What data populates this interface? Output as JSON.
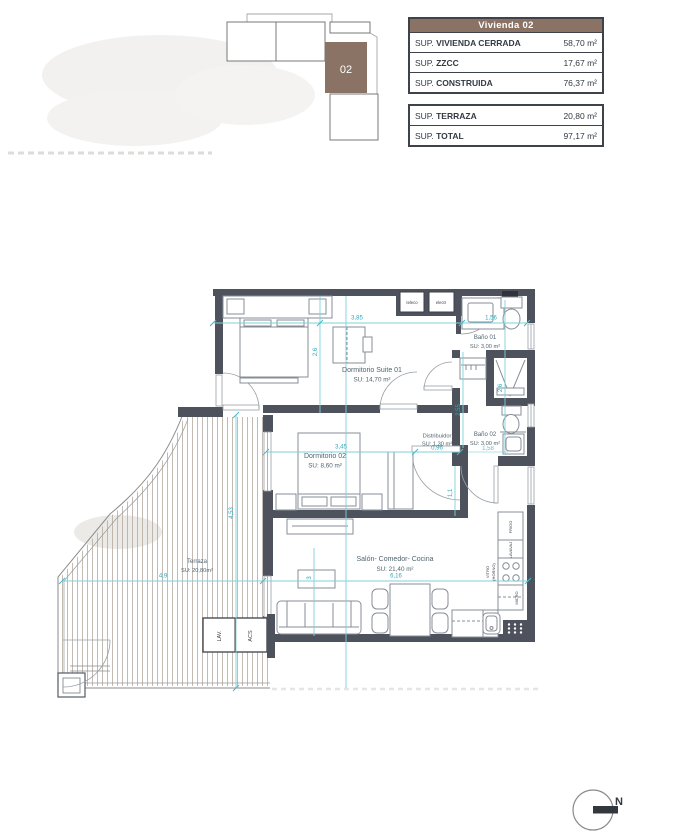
{
  "key_plan": {
    "unit": "02"
  },
  "tables": {
    "header": "Vivienda 02",
    "rows": [
      {
        "pre": "SUP. ",
        "bold": "VIVIENDA CERRADA",
        "value": "58,70 m²"
      },
      {
        "pre": "SUP. ",
        "bold": "ZZCC",
        "value": "17,67 m²"
      },
      {
        "pre": "SUP. ",
        "bold": "CONSTRUIDA",
        "value": "76,37 m²"
      },
      {
        "pre": "SUP. ",
        "bold": "TERRAZA",
        "value": "20,80 m²"
      },
      {
        "pre": "SUP. ",
        "bold": "TOTAL",
        "value": "97,17 m²"
      }
    ]
  },
  "rooms": {
    "suite": {
      "name": "Dormitorio Suite 01",
      "area": "SU: 14,70 m²"
    },
    "dorm02": {
      "name": "Dormitorio 02",
      "area": "SU: 8,60 m²"
    },
    "bano01": {
      "name": "Baño 01",
      "area": "SU: 3,00 m²"
    },
    "bano02": {
      "name": "Baño 02",
      "area": "SU: 3,00 m²"
    },
    "distribuidor": {
      "name": "Distribuidor",
      "area": "SU: 1,30 m²"
    },
    "salon": {
      "name": "Salón- Comedor- Cocina",
      "area": "SU: 21,40 m²"
    },
    "terraza": {
      "name": "Terraza",
      "area": "SU: 20,80m²"
    }
  },
  "dims": {
    "suite_w": "3,85",
    "suite_h": "2,6",
    "bano01_w": "1,56",
    "bano_right_h": "2,6",
    "dorm02_w": "3,45",
    "distr_w": "0,96",
    "closet_h": "2,55",
    "hall_h": "1,1",
    "bano02_w": "1,58",
    "terraza_w": "4,9",
    "terraza_h": "4,53",
    "salon_w": "6,16",
    "salon_h": "3"
  },
  "fixtures": {
    "teleco": "teleco",
    "electr": "electr",
    "lav": "LAV.",
    "acs": "ACS",
    "frigo": "FRIGO",
    "lavavaj": "LAVAVAJ",
    "vitro": "VITRO",
    "horno": "(HORNO)",
    "micro": "MICRO"
  },
  "compass": {
    "label": "N"
  },
  "colors": {
    "wall": "#4d525d",
    "accent_brown": "#8a7365",
    "dim_line": "#7fd1da",
    "dim_text": "#2fa9bd"
  }
}
